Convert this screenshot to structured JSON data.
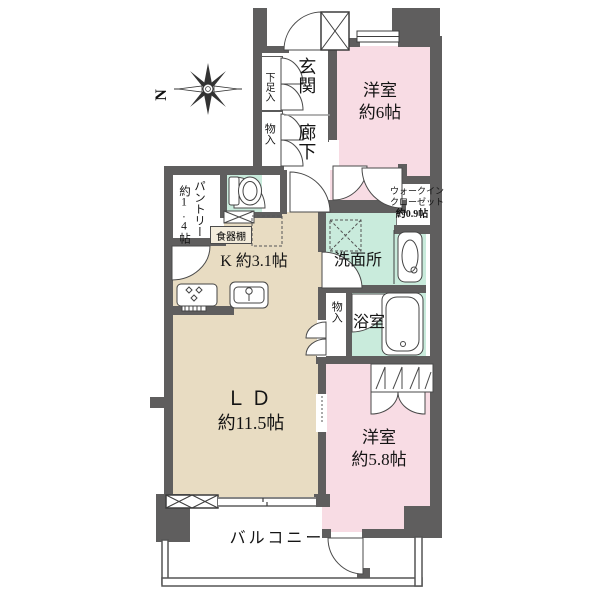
{
  "plan": {
    "compass_label": "N",
    "entrance": {
      "genkan": "玄関",
      "hallway": "廊下",
      "shoe_box": "下足入",
      "closet": "物入"
    },
    "bedroom6": {
      "name": "洋室",
      "size": "約6帖"
    },
    "wic": {
      "l1": "ウォークイン",
      "l2": "クローゼット",
      "l3": "約0.9帖"
    },
    "pantry": {
      "name": "パントリー",
      "size": "約1.4帖"
    },
    "kitchen": {
      "label": "K 約3.1帖",
      "dish_shelf": "食器棚"
    },
    "washroom": {
      "name": "洗面所"
    },
    "bathroom": {
      "name": "浴室",
      "closet": "物入"
    },
    "living": {
      "name": "ＬＤ",
      "size": "約11.5帖"
    },
    "bedroom58": {
      "name": "洋室",
      "size": "約5.8帖"
    },
    "balcony": {
      "name": "バルコニー"
    },
    "colors": {
      "wall": "#5f5e5e",
      "bedroom": "#f8dce4",
      "ldk": "#e8dcc2",
      "wet": "#c9ebdc"
    }
  }
}
